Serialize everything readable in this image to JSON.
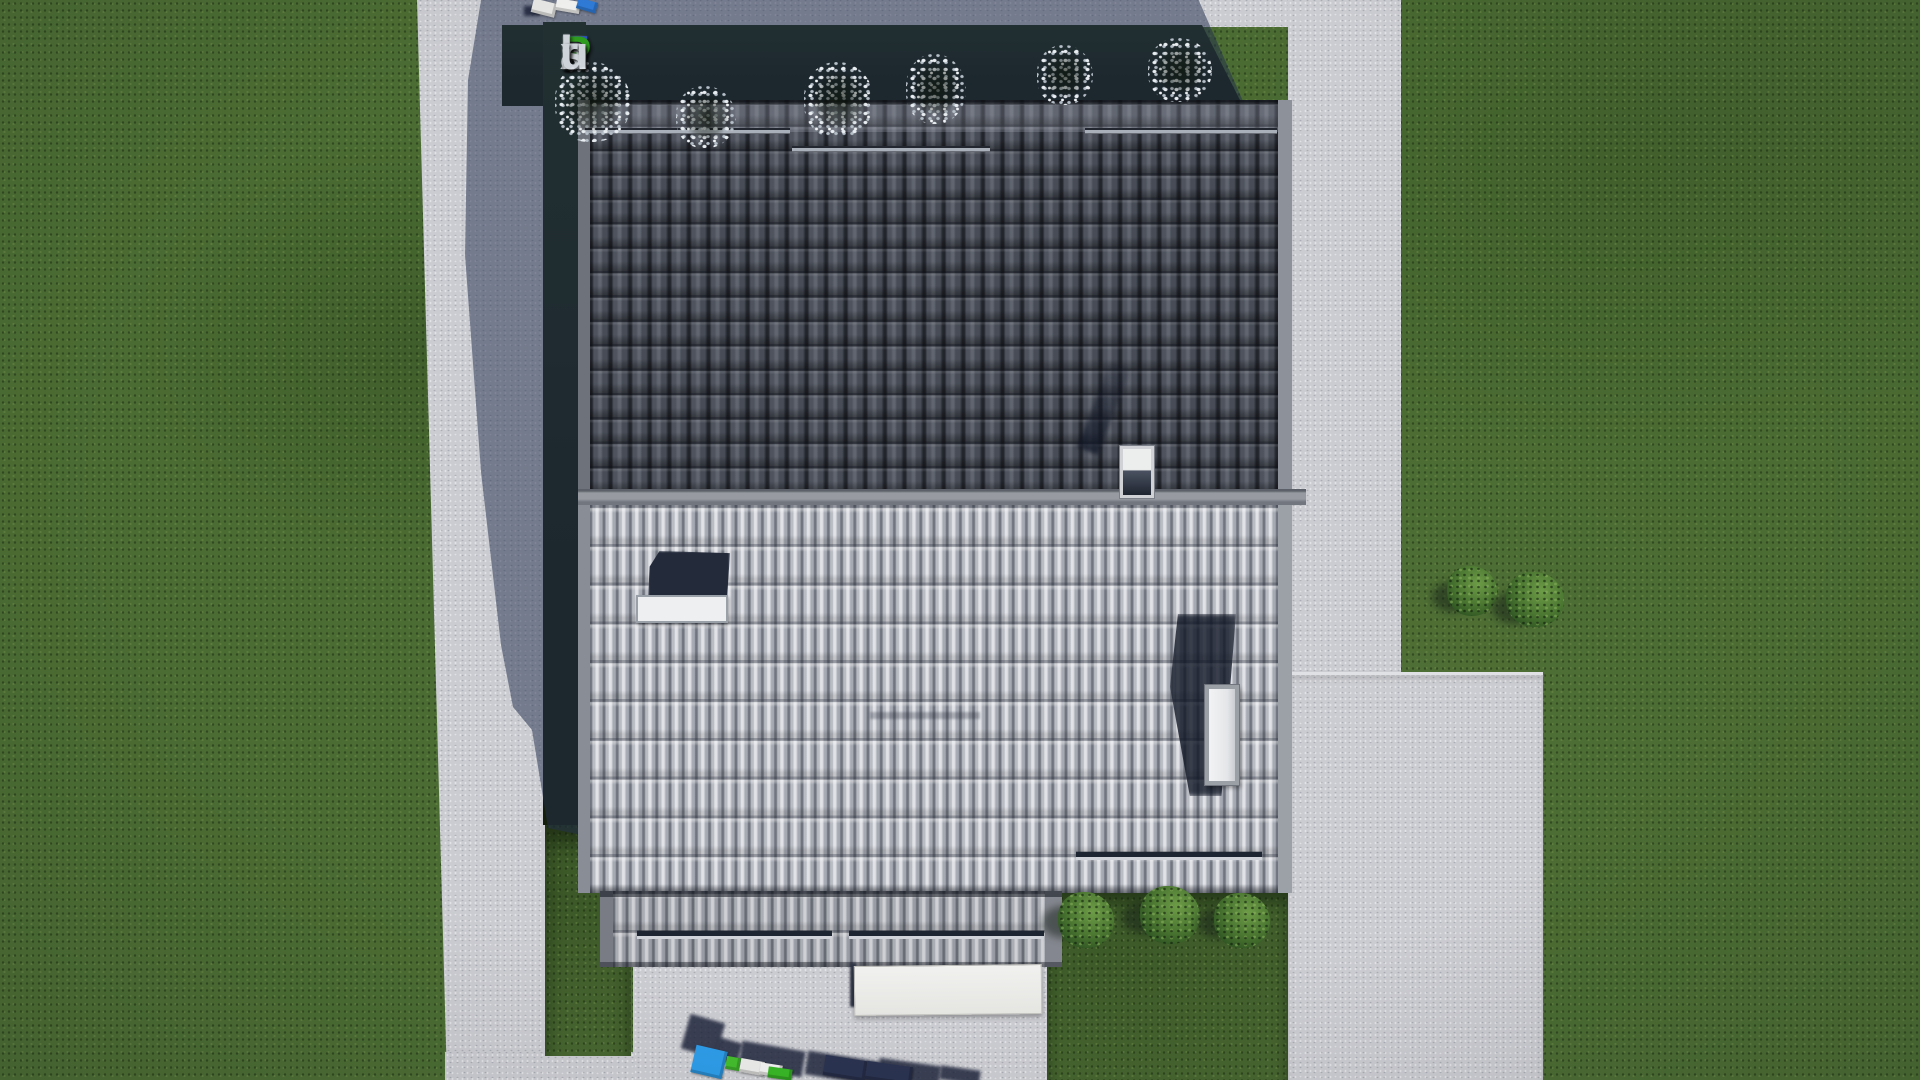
{
  "watermark": {
    "brand_text": "FixPlans.ru",
    "letters": [
      {
        "char": "F",
        "style": "color:#2b59d8"
      },
      {
        "char": "i",
        "style": "color:#d9dee4"
      },
      {
        "char": "x",
        "style": "color:#d9dee4"
      },
      {
        "char": "P",
        "style": "color:#2fa31d"
      },
      {
        "char": "l",
        "style": "color:#d9dee4"
      },
      {
        "char": "a",
        "style": "color:#d9dee4"
      },
      {
        "char": "n",
        "style": "color:#d9dee4"
      },
      {
        "char": "s",
        "style": "color:#d9dee4"
      },
      {
        "char": ".",
        "style": "color:#2b59d8"
      },
      {
        "char": "r",
        "style": "color:#d9dee4"
      },
      {
        "char": "u",
        "style": "color:#d9dee4"
      }
    ]
  },
  "colors": {
    "grass": "#4b6c33",
    "planting_bed_shade": "#141f0c",
    "concrete": "#cbccd1",
    "cast_shadow": "#39476b",
    "roof_dark_tiles": "#43474f",
    "roof_light_tiles": "#b1b4bc",
    "ridge_cap": "#8f939a",
    "fascia": "#888c94",
    "skylight_glass": "#232a3a",
    "skylight_frame": "#edeff1",
    "chimney_white": "#eff0f2",
    "awning_white": "#ececea",
    "watermark_blue": "#2b59d8",
    "watermark_green": "#2fa31d",
    "watermark_silver": "#d9dee4",
    "watermark_block_blue": "#2e9ce8",
    "watermark_block_green": "#3cbb2a"
  }
}
